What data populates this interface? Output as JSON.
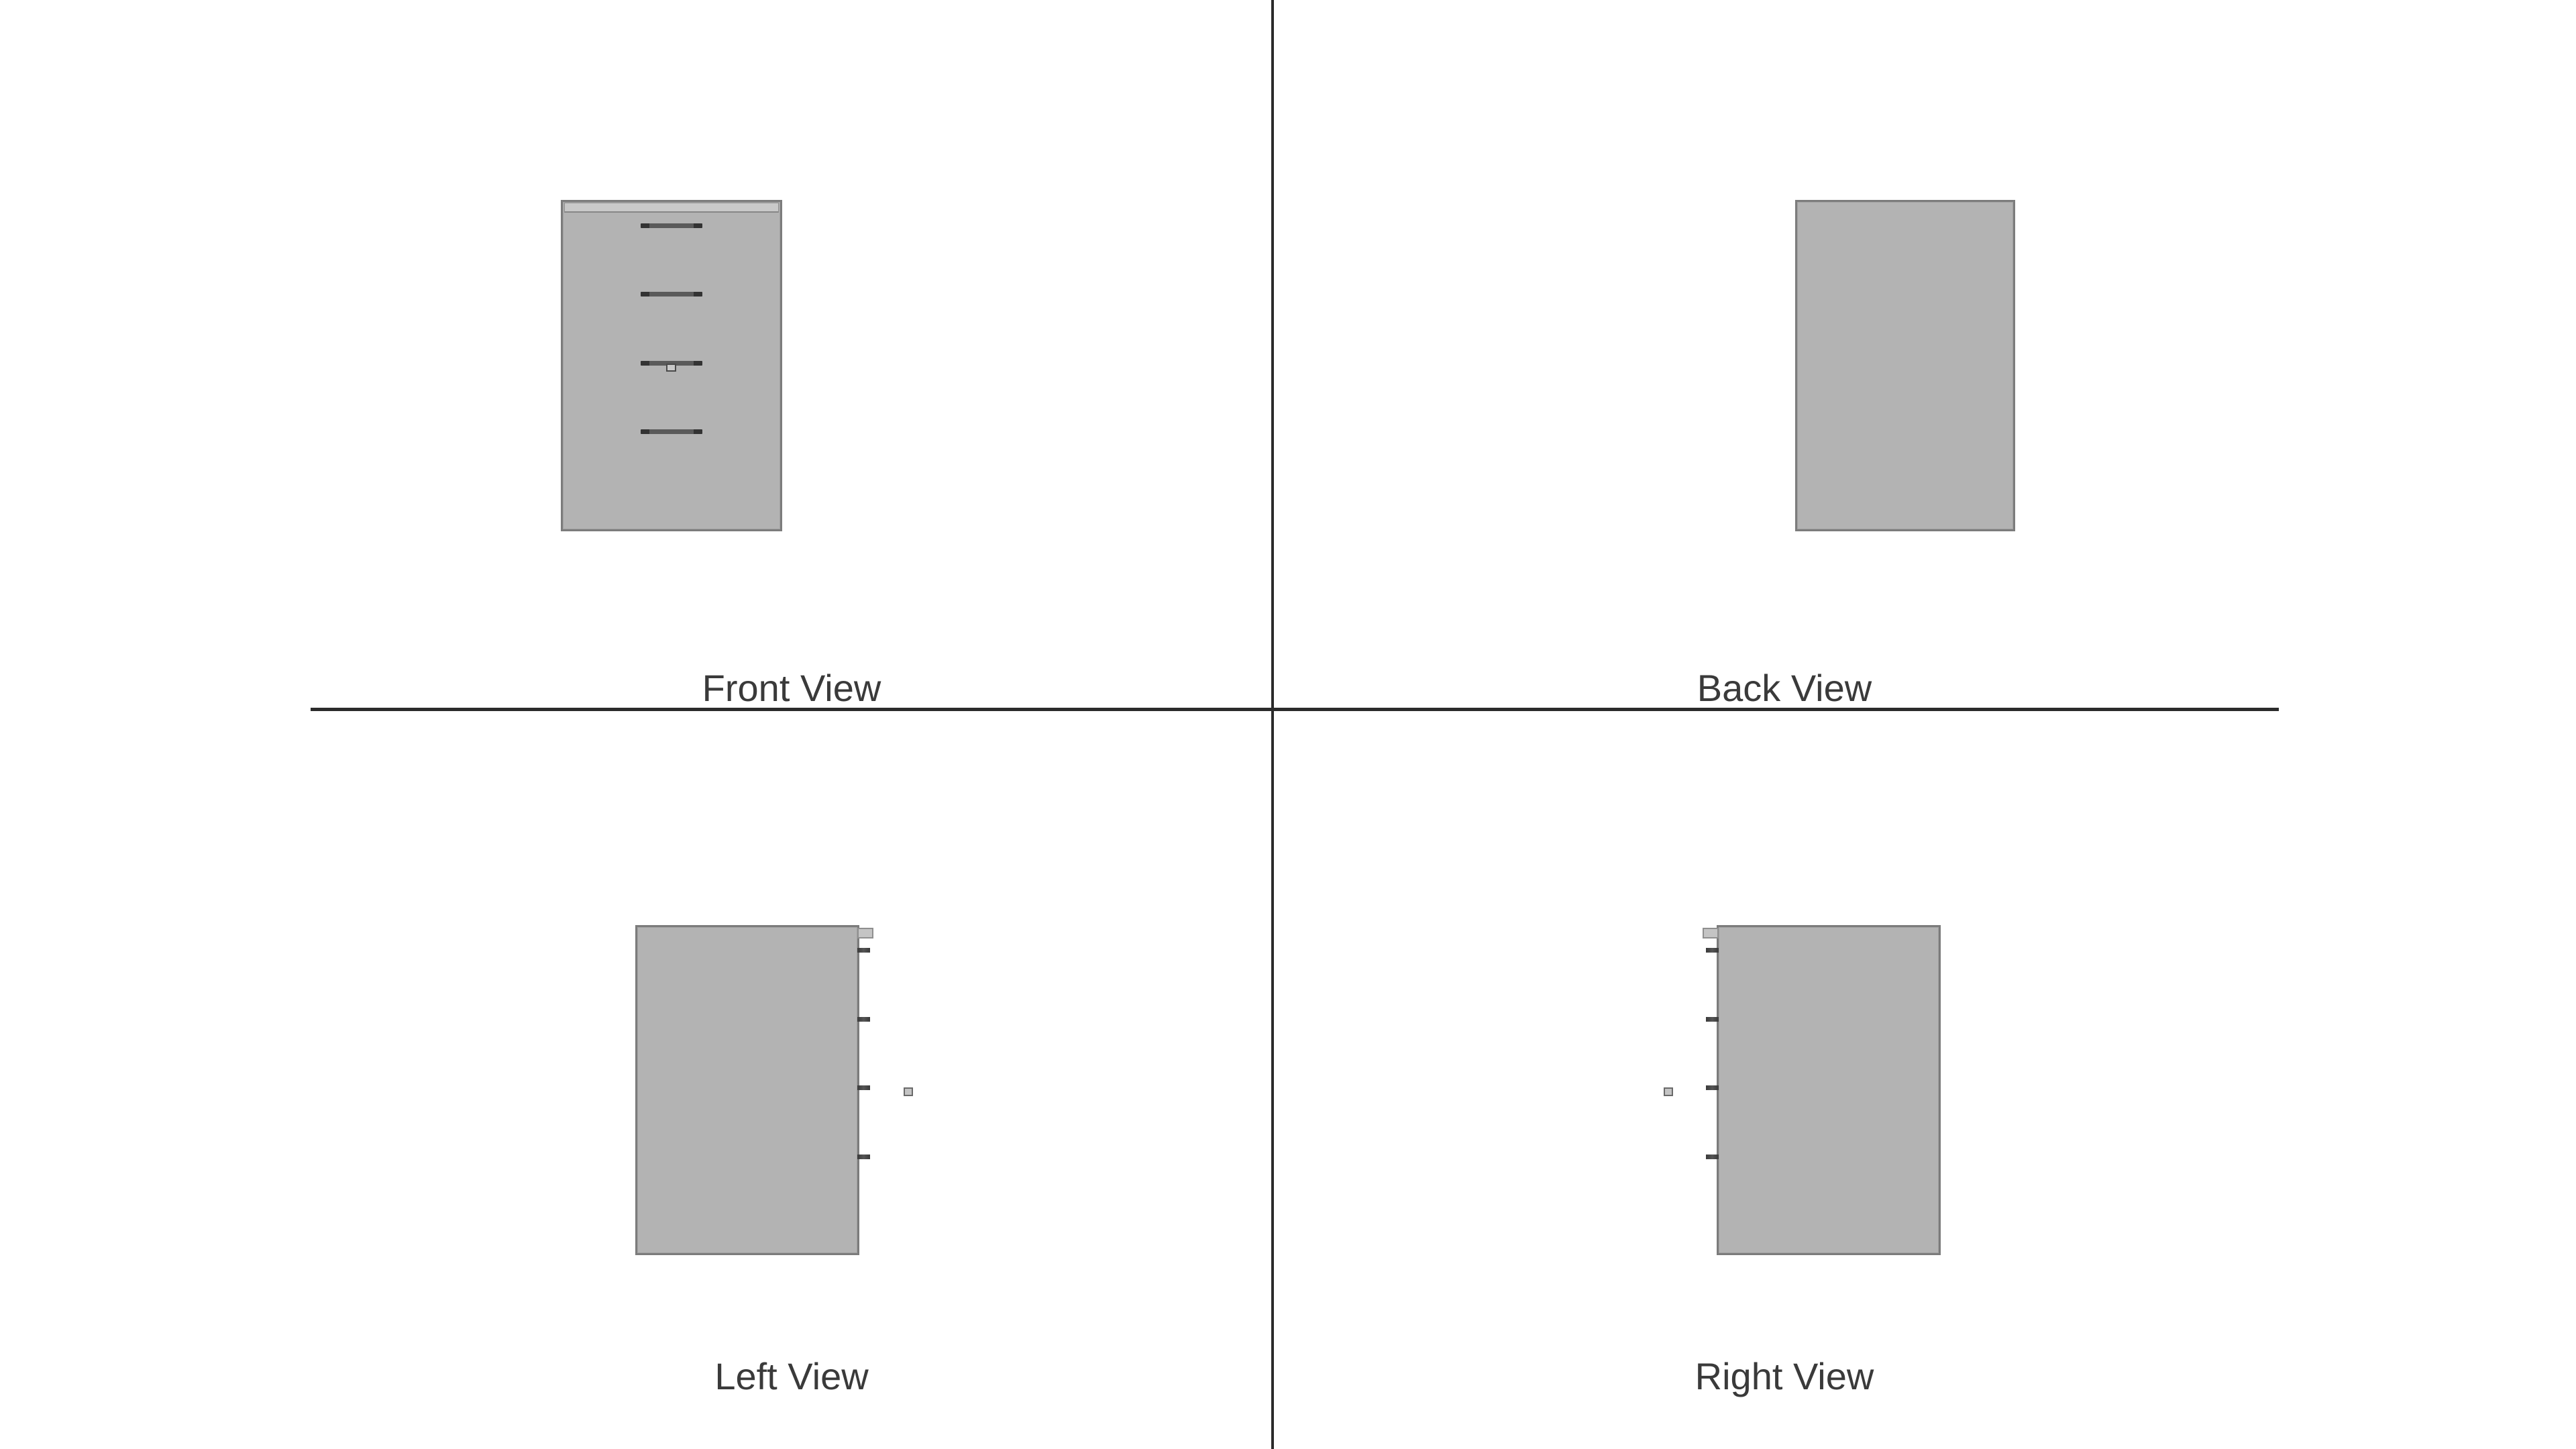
{
  "drawing": {
    "views": {
      "front": {
        "label": "Front View",
        "drawer_handles": 4,
        "has_lock_square": true
      },
      "back": {
        "label": "Back View"
      },
      "left": {
        "label": "Left View",
        "edge_ticks": 4,
        "has_lock_square": true
      },
      "right": {
        "label": "Right View",
        "edge_ticks": 4,
        "has_lock_square": true
      }
    },
    "colors": {
      "background": "#ffffff",
      "divider": "#2b2b2b",
      "panel_fill": "#b3b3b3",
      "panel_border": "#7c7c7c",
      "strip_fill": "#c9c9c9",
      "hardware_dark": "#3f3f3f",
      "hardware_light": "#c4c4c4",
      "label_text": "#3a3a3a"
    }
  }
}
